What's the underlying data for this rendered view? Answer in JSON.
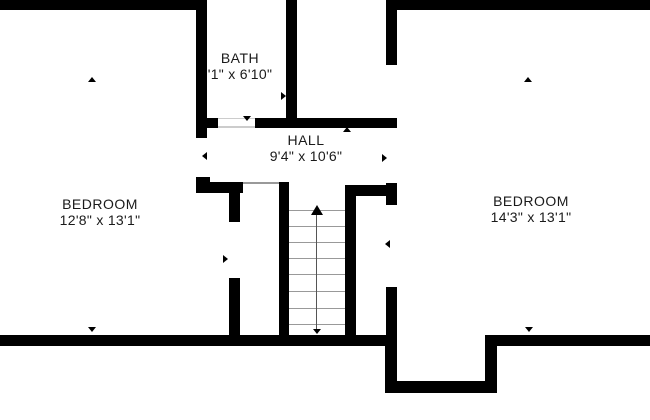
{
  "plan_title": "Second floor plan",
  "rooms": {
    "bath": {
      "name": "BATH",
      "dims": "'1\" x 6'10\""
    },
    "hall": {
      "name": "HALL",
      "dims": "9'4\" x 10'6\""
    },
    "bedroom_left": {
      "name": "BEDROOM",
      "dims": "12'8\" x 13'1\""
    },
    "bedroom_right": {
      "name": "BEDROOM",
      "dims": "14'3\" x 13'1\""
    }
  },
  "stairs": {
    "direction": "up",
    "tread_count": 8
  },
  "icons": {
    "measure_arrows": [
      "up-arrow-icon",
      "down-arrow-icon",
      "left-arrow-icon",
      "right-arrow-icon"
    ],
    "stair_direction": "up-arrow-icon"
  },
  "colors": {
    "wall": "#000000",
    "background": "#ffffff",
    "text": "#1a1a1a",
    "stair_tread": "#999999"
  }
}
